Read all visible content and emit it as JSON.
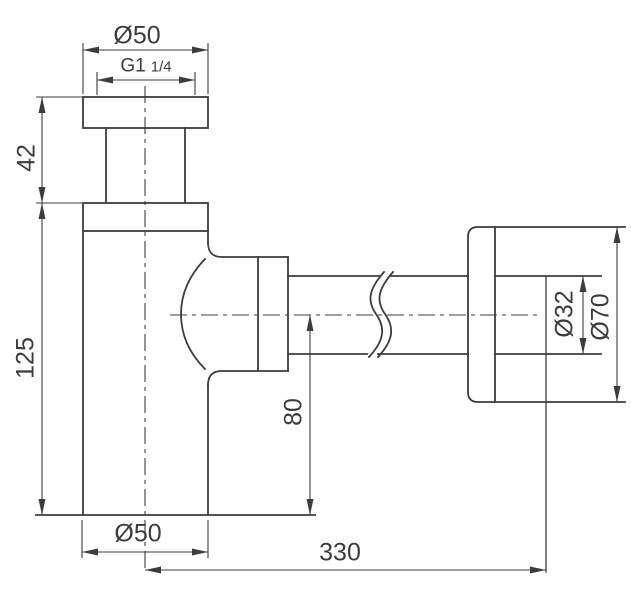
{
  "drawing": {
    "type": "technical-dimension-drawing",
    "subject": "bottle-trap-siphon-side-view",
    "background_color": "#ffffff",
    "line_color": "#3c3c3c",
    "labels": {
      "inlet_diameter": "Ø50",
      "thread_size": "G1",
      "thread_fraction": "1/4",
      "inlet_height": "42",
      "body_height": "125",
      "body_diameter": "Ø50",
      "outlet_center_height": "80",
      "wall_distance": "330",
      "pipe_diameter": "Ø32",
      "flange_diameter": "Ø70"
    }
  }
}
